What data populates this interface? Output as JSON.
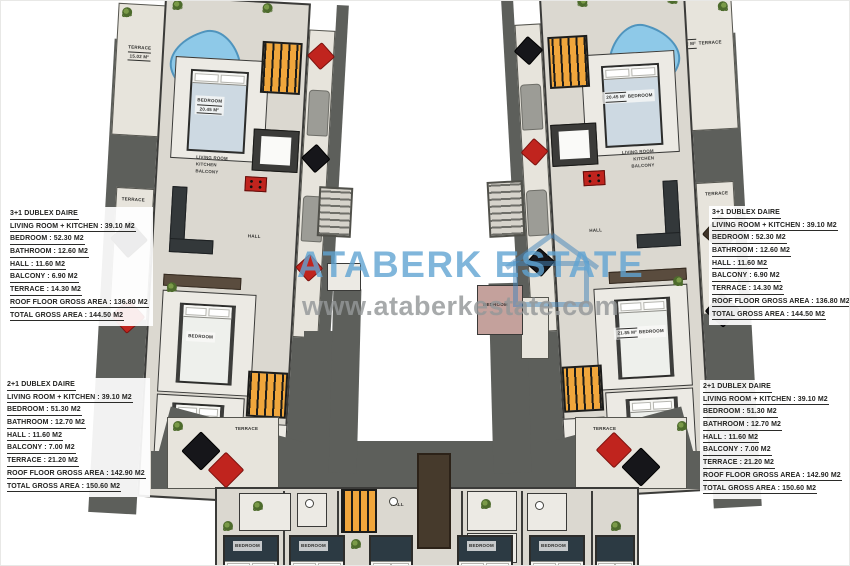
{
  "watermark": {
    "brand": "ATABERK ESTATE",
    "url": "www.ataberkestate.com"
  },
  "spec_blocks": [
    {
      "position": "top-left",
      "title": "3+1 DUBLEX DAIRE",
      "lines": [
        "LIVING ROOM + KITCHEN : 39.10 M2",
        "BEDROOM : 52.30 M2",
        "BATHROOM : 12.60 M2",
        "HALL : 11.60 M2",
        "BALCONY : 6.90 M2",
        "TERRACE : 14.30 M2",
        "ROOF FLOOR GROSS AREA : 136.80 M2",
        "TOTAL GROSS AREA : 144.50 M2"
      ]
    },
    {
      "position": "top-right",
      "title": "3+1 DUBLEX DAIRE",
      "lines": [
        "LIVING ROOM + KITCHEN : 39.10 M2",
        "BEDROOM : 52.30 M2",
        "BATHROOM : 12.60 M2",
        "HALL : 11.60 M2",
        "BALCONY : 6.90 M2",
        "TERRACE : 14.30 M2",
        "ROOF FLOOR GROSS AREA : 136.80 M2",
        "TOTAL GROSS AREA : 144.50 M2"
      ]
    },
    {
      "position": "bottom-left",
      "title": "2+1 DUBLEX DAIRE",
      "lines": [
        "LIVING ROOM + KITCHEN : 39.10 M2",
        "BEDROOM : 51.30 M2",
        "BATHROOM : 12.70 M2",
        "HALL : 11.60 M2",
        "BALCONY : 7.00 M2",
        "TERRACE : 21.20 M2",
        "ROOF FLOOR GROSS AREA : 142.90 M2",
        "TOTAL GROSS AREA : 150.60 M2"
      ]
    },
    {
      "position": "bottom-right",
      "title": "2+1 DUBLEX DAIRE",
      "lines": [
        "LIVING ROOM + KITCHEN : 39.10 M2",
        "BEDROOM : 51.30 M2",
        "BATHROOM : 12.70 M2",
        "HALL : 11.60 M2",
        "BALCONY : 7.00 M2",
        "TERRACE : 21.20 M2",
        "ROOF FLOOR GROSS AREA : 142.90 M2",
        "TOTAL GROSS AREA : 150.60 M2"
      ]
    }
  ],
  "rooms": {
    "terrace": "TERRACE",
    "bedroom": "BEDROOM",
    "living_room": "LIVING ROOM",
    "kitchen": "KITCHEN",
    "balcony": "BALCONY",
    "hall": "HALL",
    "terrace_tl_area": "15.02 M²",
    "terrace_tr_area": "14.62 M²",
    "bedroom_tl_area": "20.45 M²",
    "bedroom_tr_area": "20.45 M²",
    "bedroom_mid_area": "21.85 M²"
  },
  "colors": {
    "slab_gray": "#5d5f5b",
    "floor_beige": "#dbd8d0",
    "stair_orange": "#f0a63c",
    "pool_blue": "#8ec9e8",
    "accent_red": "#c0241e",
    "watermark_blue": "#60a4d2",
    "watermark_gray": "#949799"
  }
}
